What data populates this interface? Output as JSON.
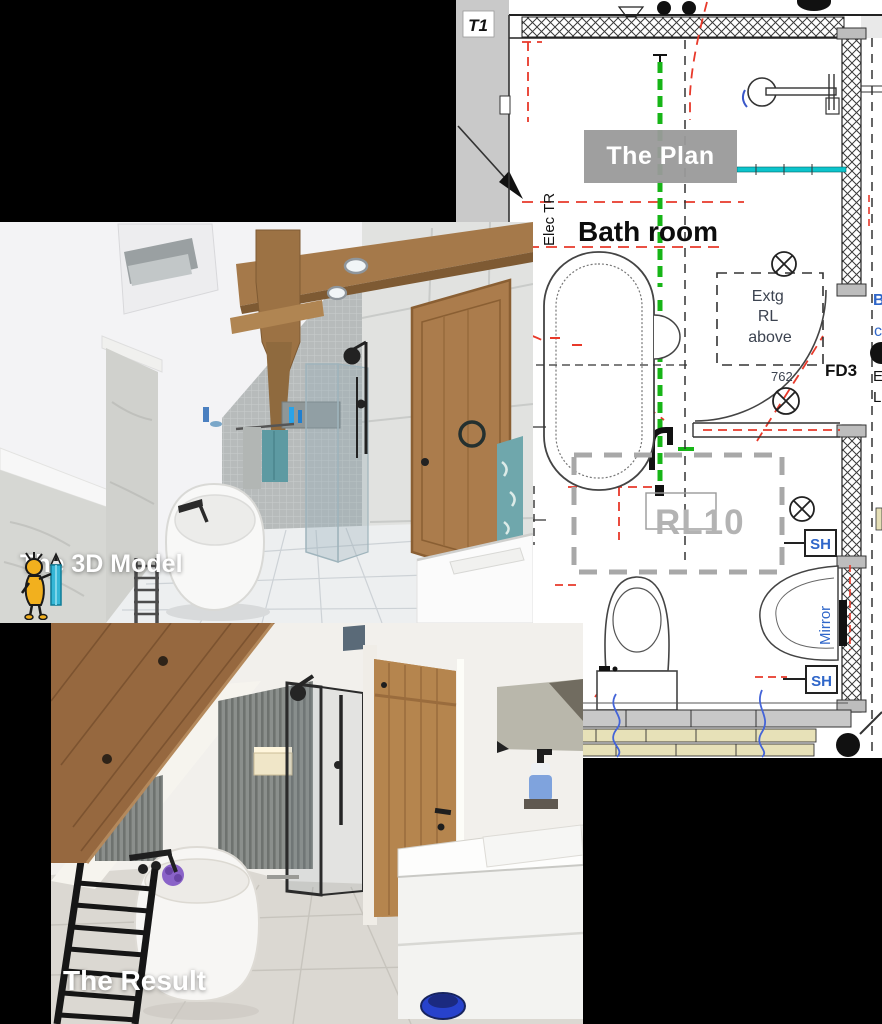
{
  "collage": {
    "background": "#000000",
    "steps": [
      "The Plan",
      "The 3D Model",
      "The Result"
    ]
  },
  "plan": {
    "label": "The Plan",
    "sheet_tag": "T1",
    "room_name": "Bath room",
    "elec_label": "Elec TR",
    "extg_note_lines": [
      "Extg",
      "RL",
      "above"
    ],
    "door_tag": "FD3",
    "door_dimension": "762",
    "zone_tag": "RL10",
    "shower_tag_upper": "SH",
    "shower_tag_lower": "SH",
    "mirror_label": "Mirror",
    "edge_text": {
      "b": "B",
      "c": "c",
      "e": "E",
      "l": "L"
    },
    "colors": {
      "demolition_red": "#e8392a",
      "new_work_green": "#17b517",
      "cyan_fixture": "#0cc4cc",
      "zone_gray": "#ababab",
      "annotation_blue": "#2f66c9"
    }
  },
  "model": {
    "label": "The 3D Model"
  },
  "result": {
    "label": "The Result"
  }
}
